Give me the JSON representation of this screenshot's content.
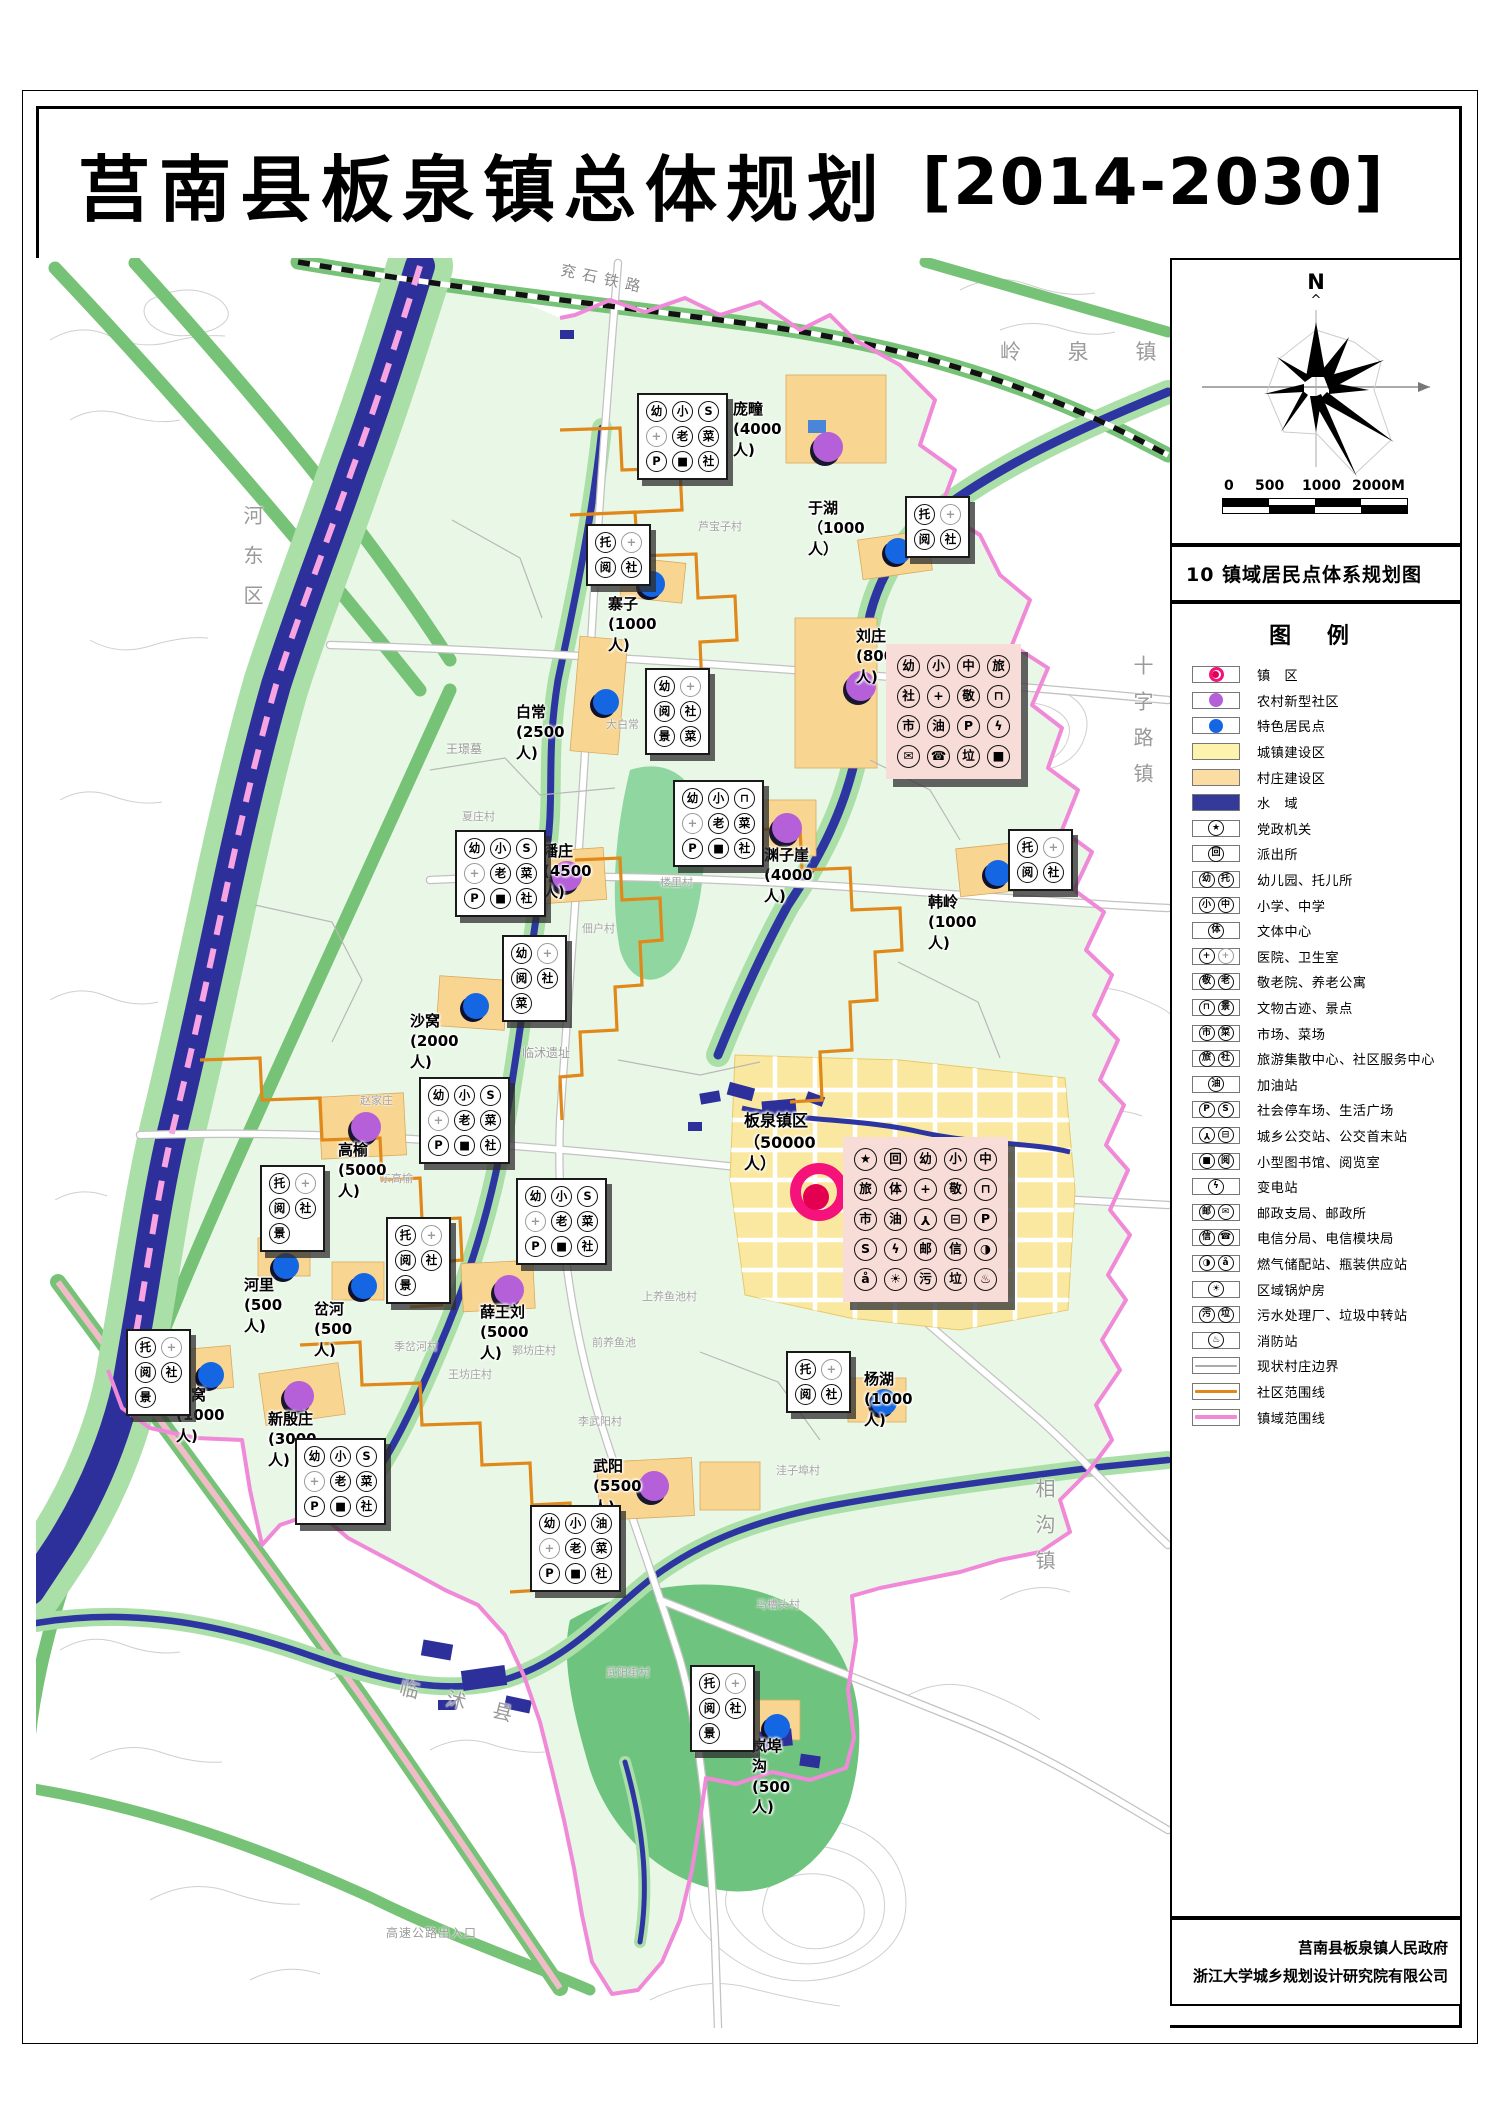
{
  "title": {
    "main": "莒南县板泉镇总体规划",
    "period": "[2014-2030]"
  },
  "sidebar": {
    "north_label": "N",
    "north_caret": "^",
    "scale": {
      "ticks": [
        "0",
        "500",
        "1000",
        "2000M"
      ]
    },
    "map_number_title": "10  镇域居民点体系规划图",
    "legend": {
      "title": "图  例",
      "items": [
        {
          "label": "镇　区",
          "sym": "marker",
          "marker": "town"
        },
        {
          "label": "农村新型社区",
          "sym": "marker",
          "marker": "community"
        },
        {
          "label": "特色居民点",
          "sym": "marker",
          "marker": "feature"
        },
        {
          "label": "城镇建设区",
          "sym": "swatch",
          "color": "#fdf2ae"
        },
        {
          "label": "村庄建设区",
          "sym": "swatch",
          "color": "#fbdda4"
        },
        {
          "label": "水　域",
          "sym": "swatch",
          "color": "#333a99"
        },
        {
          "label": "党政机关",
          "sym": "icons",
          "icons": [
            "star"
          ]
        },
        {
          "label": "派出所",
          "sym": "icons",
          "icons": [
            "shield"
          ]
        },
        {
          "label": "幼儿园、托儿所",
          "sym": "icons",
          "icons": [
            "幼",
            "托"
          ]
        },
        {
          "label": "小学、中学",
          "sym": "icons",
          "icons": [
            "小",
            "中"
          ]
        },
        {
          "label": "文体中心",
          "sym": "icons",
          "icons": [
            "体"
          ]
        },
        {
          "label": "医院、卫生室",
          "sym": "icons",
          "icons": [
            "cross",
            "crossg"
          ]
        },
        {
          "label": "敬老院、养老公寓",
          "sym": "icons",
          "icons": [
            "敬",
            "老"
          ]
        },
        {
          "label": "文物古迹、景点",
          "sym": "icons",
          "icons": [
            "mon",
            "景"
          ]
        },
        {
          "label": "市场、菜场",
          "sym": "icons",
          "icons": [
            "市",
            "菜"
          ]
        },
        {
          "label": "旅游集散中心、社区服务中心",
          "sym": "icons",
          "icons": [
            "旅",
            "社"
          ]
        },
        {
          "label": "加油站",
          "sym": "icons",
          "icons": [
            "油"
          ]
        },
        {
          "label": "社会停车场、生活广场",
          "sym": "icons",
          "icons": [
            "P",
            "S"
          ]
        },
        {
          "label": "城乡公交站、公交首末站",
          "sym": "icons",
          "icons": [
            "wheel",
            "bus"
          ]
        },
        {
          "label": "小型图书馆、阅览室",
          "sym": "icons",
          "icons": [
            "book",
            "阅"
          ]
        },
        {
          "label": "变电站",
          "sym": "icons",
          "icons": [
            "bolt"
          ]
        },
        {
          "label": "邮政支局、邮政所",
          "sym": "icons",
          "icons": [
            "邮",
            "env"
          ]
        },
        {
          "label": "电信分局、电信模块局",
          "sym": "icons",
          "icons": [
            "信",
            "tel"
          ]
        },
        {
          "label": "燃气储配站、瓶装供应站",
          "sym": "icons",
          "icons": [
            "gas",
            "bottle"
          ]
        },
        {
          "label": "区域锅炉房",
          "sym": "icons",
          "icons": [
            "boiler"
          ]
        },
        {
          "label": "污水处理厂、垃圾中转站",
          "sym": "icons",
          "icons": [
            "污",
            "垃"
          ]
        },
        {
          "label": "消防站",
          "sym": "icons",
          "icons": [
            "fire"
          ]
        },
        {
          "label": "现状村庄边界",
          "sym": "line",
          "color": "#aaaaaa",
          "weight": 2
        },
        {
          "label": "社区范围线",
          "sym": "line",
          "color": "#e0891a",
          "weight": 3
        },
        {
          "label": "镇域范围线",
          "sym": "line",
          "color": "#f08ad8",
          "weight": 4
        }
      ]
    },
    "credits": [
      "莒南县板泉镇人民政府",
      "浙江大学城乡规划设计研究院有限公司"
    ]
  },
  "map": {
    "colors": {
      "town_marker": "#f5127a",
      "community_dot": "#b55fd8",
      "feature_dot": "#1566e2",
      "town_area": "#fdf2ae",
      "village_area": "#fbdda4",
      "water": "#333a99",
      "community_line": "#e0891a",
      "boundary_line": "#f08ad8"
    },
    "region_labels": [
      {
        "text": "兖石铁路",
        "x": 560,
        "y": 268,
        "size": 15,
        "color": "#8a8a8a",
        "rot": 12,
        "ls": 7
      },
      {
        "text": "岭 泉 镇",
        "x": 1000,
        "y": 336,
        "size": 21,
        "color": "#9a9a9a",
        "ls": 20
      },
      {
        "text": "河东区",
        "x": 238,
        "y": 505,
        "size": 20,
        "color": "#9a9a9a",
        "vert": true,
        "ls": 20
      },
      {
        "text": "十字路镇",
        "x": 1128,
        "y": 655,
        "size": 20,
        "color": "#9a9a9a",
        "vert": true,
        "ls": 16
      },
      {
        "text": "相沟镇",
        "x": 1030,
        "y": 1478,
        "size": 20,
        "color": "#9a9a9a",
        "vert": true,
        "ls": 16
      },
      {
        "text": "临沭县",
        "x": 398,
        "y": 1688,
        "size": 20,
        "color": "#9a9a9a",
        "rot": 14,
        "ls": 28
      },
      {
        "text": "高速公路出入口",
        "x": 386,
        "y": 1924,
        "size": 12,
        "color": "#9a9a9a",
        "ls": 1
      },
      {
        "text": "王璟墓",
        "x": 446,
        "y": 740,
        "size": 12,
        "color": "#9a9a9a"
      },
      {
        "text": "芦宝子村",
        "x": 698,
        "y": 518,
        "size": 11,
        "color": "#a3a3a3"
      },
      {
        "text": "大白常",
        "x": 606,
        "y": 716,
        "size": 11,
        "color": "#a3a3a3"
      },
      {
        "text": "夏庄村",
        "x": 462,
        "y": 808,
        "size": 11,
        "color": "#a3a3a3"
      },
      {
        "text": "楼里村",
        "x": 660,
        "y": 874,
        "size": 11,
        "color": "#a3a3a3"
      },
      {
        "text": "佃户村",
        "x": 582,
        "y": 920,
        "size": 11,
        "color": "#a3a3a3"
      },
      {
        "text": "临沭遗址",
        "x": 522,
        "y": 1044,
        "size": 12,
        "color": "#9a9a9a"
      },
      {
        "text": "赵家庄",
        "x": 360,
        "y": 1092,
        "size": 11,
        "color": "#a3a3a3"
      },
      {
        "text": "东高榆",
        "x": 380,
        "y": 1170,
        "size": 11,
        "color": "#a3a3a3"
      },
      {
        "text": "上养鱼池村",
        "x": 642,
        "y": 1288,
        "size": 11,
        "color": "#a3a3a3"
      },
      {
        "text": "前养鱼池",
        "x": 592,
        "y": 1334,
        "size": 11,
        "color": "#a3a3a3"
      },
      {
        "text": "季岔河村",
        "x": 394,
        "y": 1338,
        "size": 11,
        "color": "#a3a3a3"
      },
      {
        "text": "郭坊庄村",
        "x": 512,
        "y": 1342,
        "size": 11,
        "color": "#a3a3a3"
      },
      {
        "text": "王坊庄村",
        "x": 448,
        "y": 1366,
        "size": 11,
        "color": "#a3a3a3"
      },
      {
        "text": "李武阳村",
        "x": 578,
        "y": 1413,
        "size": 11,
        "color": "#a3a3a3"
      },
      {
        "text": "洼子埠村",
        "x": 776,
        "y": 1462,
        "size": 11,
        "color": "#a3a3a3"
      },
      {
        "text": "马槽头村",
        "x": 756,
        "y": 1596,
        "size": 11,
        "color": "#a3a3a3"
      },
      {
        "text": "武阳街村",
        "x": 606,
        "y": 1664,
        "size": 11,
        "color": "#a3a3a3"
      }
    ],
    "settlements": [
      {
        "id": "pangtuan",
        "name": "庞疃(4000人)",
        "kind": "community",
        "dot": [
          828,
          447
        ],
        "label": [
          733,
          399
        ],
        "box": [
          637,
          393
        ],
        "cols": 3,
        "icons": [
          "幼",
          "小",
          "S",
          "crossg",
          "老",
          "菜",
          "P",
          "book",
          "社"
        ]
      },
      {
        "id": "yuhu",
        "name": "于湖（1000人）",
        "kind": "feature",
        "dot": [
          898,
          551
        ],
        "label": [
          808,
          498
        ],
        "box": [
          905,
          496
        ],
        "cols": 2,
        "icons": [
          "托",
          "crossg",
          "阅",
          "社"
        ]
      },
      {
        "id": "zhaizi",
        "name": "寨子(1000人)",
        "kind": "feature",
        "dot": [
          652,
          584
        ],
        "label": [
          608,
          594
        ],
        "box": [
          586,
          524
        ],
        "cols": 2,
        "icons": [
          "托",
          "crossg",
          "阅",
          "社"
        ]
      },
      {
        "id": "baichang",
        "name": "白常(2500人)",
        "kind": "feature",
        "dot": [
          606,
          702
        ],
        "label": [
          516,
          702
        ],
        "box": [
          645,
          668
        ],
        "cols": 2,
        "icons": [
          "幼",
          "crossg",
          "阅",
          "社",
          "景",
          "菜"
        ]
      },
      {
        "id": "liuzhuang",
        "name": "刘庄(8000人)",
        "kind": "community",
        "pink": true,
        "dot": [
          861,
          686
        ],
        "label": [
          856,
          626
        ],
        "box": [
          886,
          644
        ],
        "cols": 4,
        "icons": [
          "幼",
          "小",
          "中",
          "旅",
          "社",
          "cross",
          "敬",
          "mon",
          "市",
          "油",
          "P",
          "bolt",
          "env",
          "tel",
          "垃",
          "book"
        ]
      },
      {
        "id": "panzhuang",
        "name": "潘庄(4500人)",
        "kind": "community",
        "dot": [
          567,
          876
        ],
        "label": [
          543,
          841
        ],
        "box": [
          455,
          830
        ],
        "cols": 3,
        "icons": [
          "幼",
          "小",
          "S",
          "crossg",
          "老",
          "菜",
          "P",
          "book",
          "社"
        ]
      },
      {
        "id": "yuanziya",
        "name": "渊子崖(4000人)",
        "kind": "community",
        "dot": [
          787,
          828
        ],
        "label": [
          764,
          845
        ],
        "box": [
          673,
          780
        ],
        "cols": 3,
        "icons": [
          "幼",
          "小",
          "mon",
          "crossg",
          "老",
          "菜",
          "P",
          "book",
          "社"
        ]
      },
      {
        "id": "hanling",
        "name": "韩岭(1000人)",
        "kind": "feature",
        "dot": [
          998,
          873
        ],
        "label": [
          928,
          892
        ],
        "box": [
          1008,
          829
        ],
        "cols": 2,
        "icons": [
          "托",
          "crossg",
          "阅",
          "社"
        ]
      },
      {
        "id": "shawo",
        "name": "沙窝(2000人)",
        "kind": "feature",
        "dot": [
          476,
          1006
        ],
        "label": [
          410,
          1011
        ],
        "box": [
          502,
          935
        ],
        "cols": 2,
        "icons": [
          "幼",
          "crossg",
          "阅",
          "社",
          "菜",
          ""
        ]
      },
      {
        "id": "gaoyu",
        "name": "高榆(5000人)",
        "kind": "community",
        "dot": [
          366,
          1127
        ],
        "label": [
          338,
          1140
        ],
        "box": [
          419,
          1077
        ],
        "cols": 3,
        "icons": [
          "幼",
          "小",
          "S",
          "crossg",
          "老",
          "菜",
          "P",
          "book",
          "社"
        ]
      },
      {
        "id": "banquan",
        "name": "板泉镇区\n（50000人）",
        "kind": "town",
        "dot": [
          819,
          1192
        ],
        "label": [
          744,
          1110
        ],
        "box": [
          843,
          1137
        ],
        "cols": 5,
        "pink": true,
        "icons": [
          "star",
          "shield",
          "幼",
          "小",
          "中",
          "旅",
          "体",
          "cross",
          "敬",
          "mon",
          "市",
          "油",
          "wheel",
          "bus",
          "P",
          "S",
          "bolt",
          "邮",
          "信",
          "gas",
          "bottle",
          "boiler",
          "污",
          "垃",
          "fire"
        ]
      },
      {
        "id": "heli",
        "name": "河里(500人)",
        "kind": "feature",
        "dot": [
          286,
          1266
        ],
        "label": [
          244,
          1275
        ],
        "box": [
          260,
          1165
        ],
        "cols": 2,
        "icons": [
          "托",
          "crossg",
          "阅",
          "社",
          "景",
          ""
        ]
      },
      {
        "id": "chahe",
        "name": "岔河(500人)",
        "kind": "feature",
        "dot": [
          364,
          1286
        ],
        "label": [
          314,
          1299
        ],
        "box": [
          386,
          1217
        ],
        "cols": 2,
        "icons": [
          "托",
          "crossg",
          "阅",
          "社",
          "景",
          ""
        ]
      },
      {
        "id": "xuewangliu",
        "name": "薛王刘(5000人)",
        "kind": "community",
        "dot": [
          509,
          1290
        ],
        "label": [
          480,
          1302
        ],
        "box": [
          516,
          1178
        ],
        "cols": 3,
        "icons": [
          "幼",
          "小",
          "S",
          "crossg",
          "老",
          "菜",
          "P",
          "book",
          "社"
        ]
      },
      {
        "id": "longwo",
        "name": "龙窝(1000人)",
        "kind": "feature",
        "dot": [
          211,
          1375
        ],
        "label": [
          176,
          1385
        ],
        "box": [
          126,
          1329
        ],
        "cols": 2,
        "icons": [
          "托",
          "crossg",
          "阅",
          "社",
          "景",
          ""
        ]
      },
      {
        "id": "xinyinzhuang",
        "name": "新殷庄(3000人)",
        "kind": "community",
        "dot": [
          299,
          1396
        ],
        "label": [
          268,
          1409
        ],
        "box": [
          295,
          1438
        ],
        "cols": 3,
        "icons": [
          "幼",
          "小",
          "S",
          "crossg",
          "老",
          "菜",
          "P",
          "book",
          "社"
        ]
      },
      {
        "id": "wuyang",
        "name": "武阳(5500人)",
        "kind": "community",
        "dot": [
          654,
          1486
        ],
        "label": [
          593,
          1456
        ],
        "box": [
          530,
          1505
        ],
        "cols": 3,
        "icons": [
          "幼",
          "小",
          "油",
          "crossg",
          "老",
          "菜",
          "P",
          "book",
          "社"
        ]
      },
      {
        "id": "yanghu",
        "name": "杨湖 (1000人)",
        "kind": "feature",
        "dot": [
          884,
          1402
        ],
        "label": [
          864,
          1369
        ],
        "box": [
          786,
          1351
        ],
        "cols": 2,
        "icons": [
          "托",
          "crossg",
          "阅",
          "社"
        ]
      },
      {
        "id": "lanbugou",
        "name": "岚埠沟(500人)",
        "kind": "feature",
        "dot": [
          777,
          1727
        ],
        "label": [
          752,
          1736
        ],
        "box": [
          690,
          1665
        ],
        "cols": 2,
        "icons": [
          "托",
          "crossg",
          "阅",
          "社",
          "景",
          ""
        ]
      }
    ]
  }
}
